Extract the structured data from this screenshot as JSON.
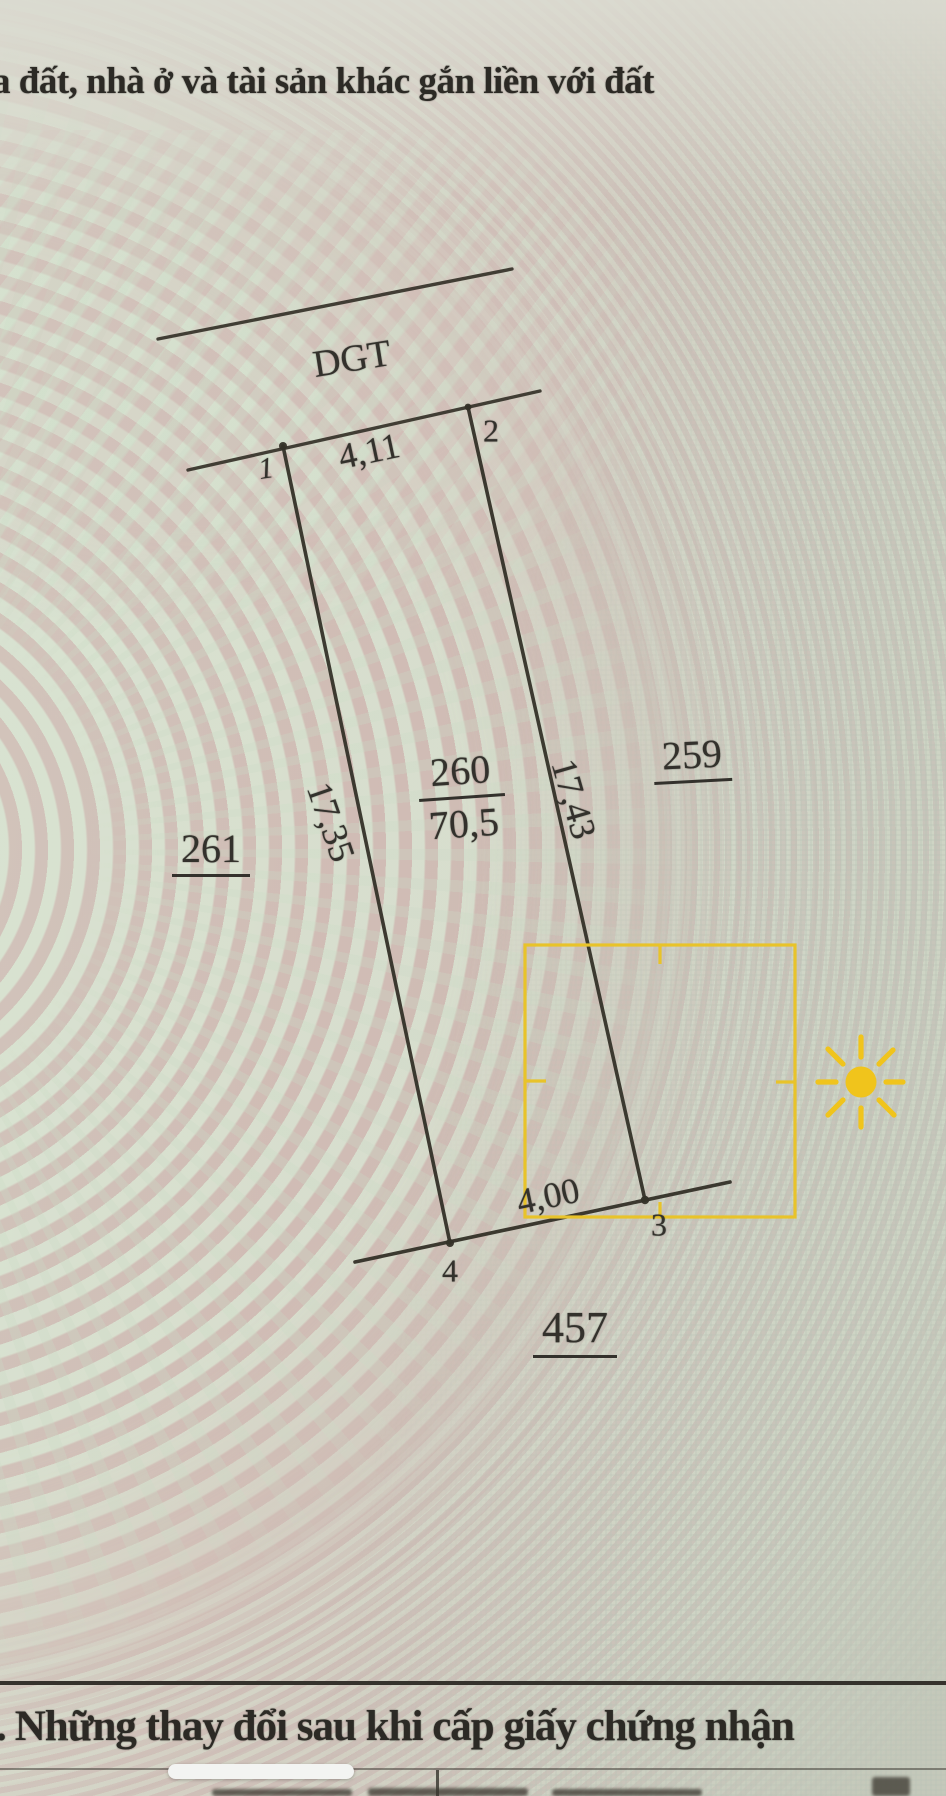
{
  "document": {
    "top_heading": "a đất, nhà ở và tài sản khác gắn liền với đất",
    "bottom_heading_leading_fragment": ".",
    "bottom_heading": "Những thay đổi sau khi cấp giấy chứng nhận"
  },
  "diagram": {
    "road_label": "DGT",
    "parcel_number": "260",
    "parcel_area": "70,5",
    "edge_lengths": {
      "top": "4,11",
      "right": "17,43",
      "bottom": "4,00",
      "left": "17,35"
    },
    "corner_labels": {
      "c1": "1",
      "c2": "2",
      "c3": "3",
      "c4": "4"
    },
    "adjacent_parcels": {
      "left": "261",
      "right": "259",
      "bottom": "457"
    }
  },
  "overlay": {
    "selection_box_color": "#e8c32a",
    "sun_color": "#f0c41c"
  },
  "colors": {
    "ink": "#343128",
    "paper_pink": "#d2bcb5",
    "paper_green": "#d8e5d3",
    "paper_gray": "#c6c9bb"
  }
}
